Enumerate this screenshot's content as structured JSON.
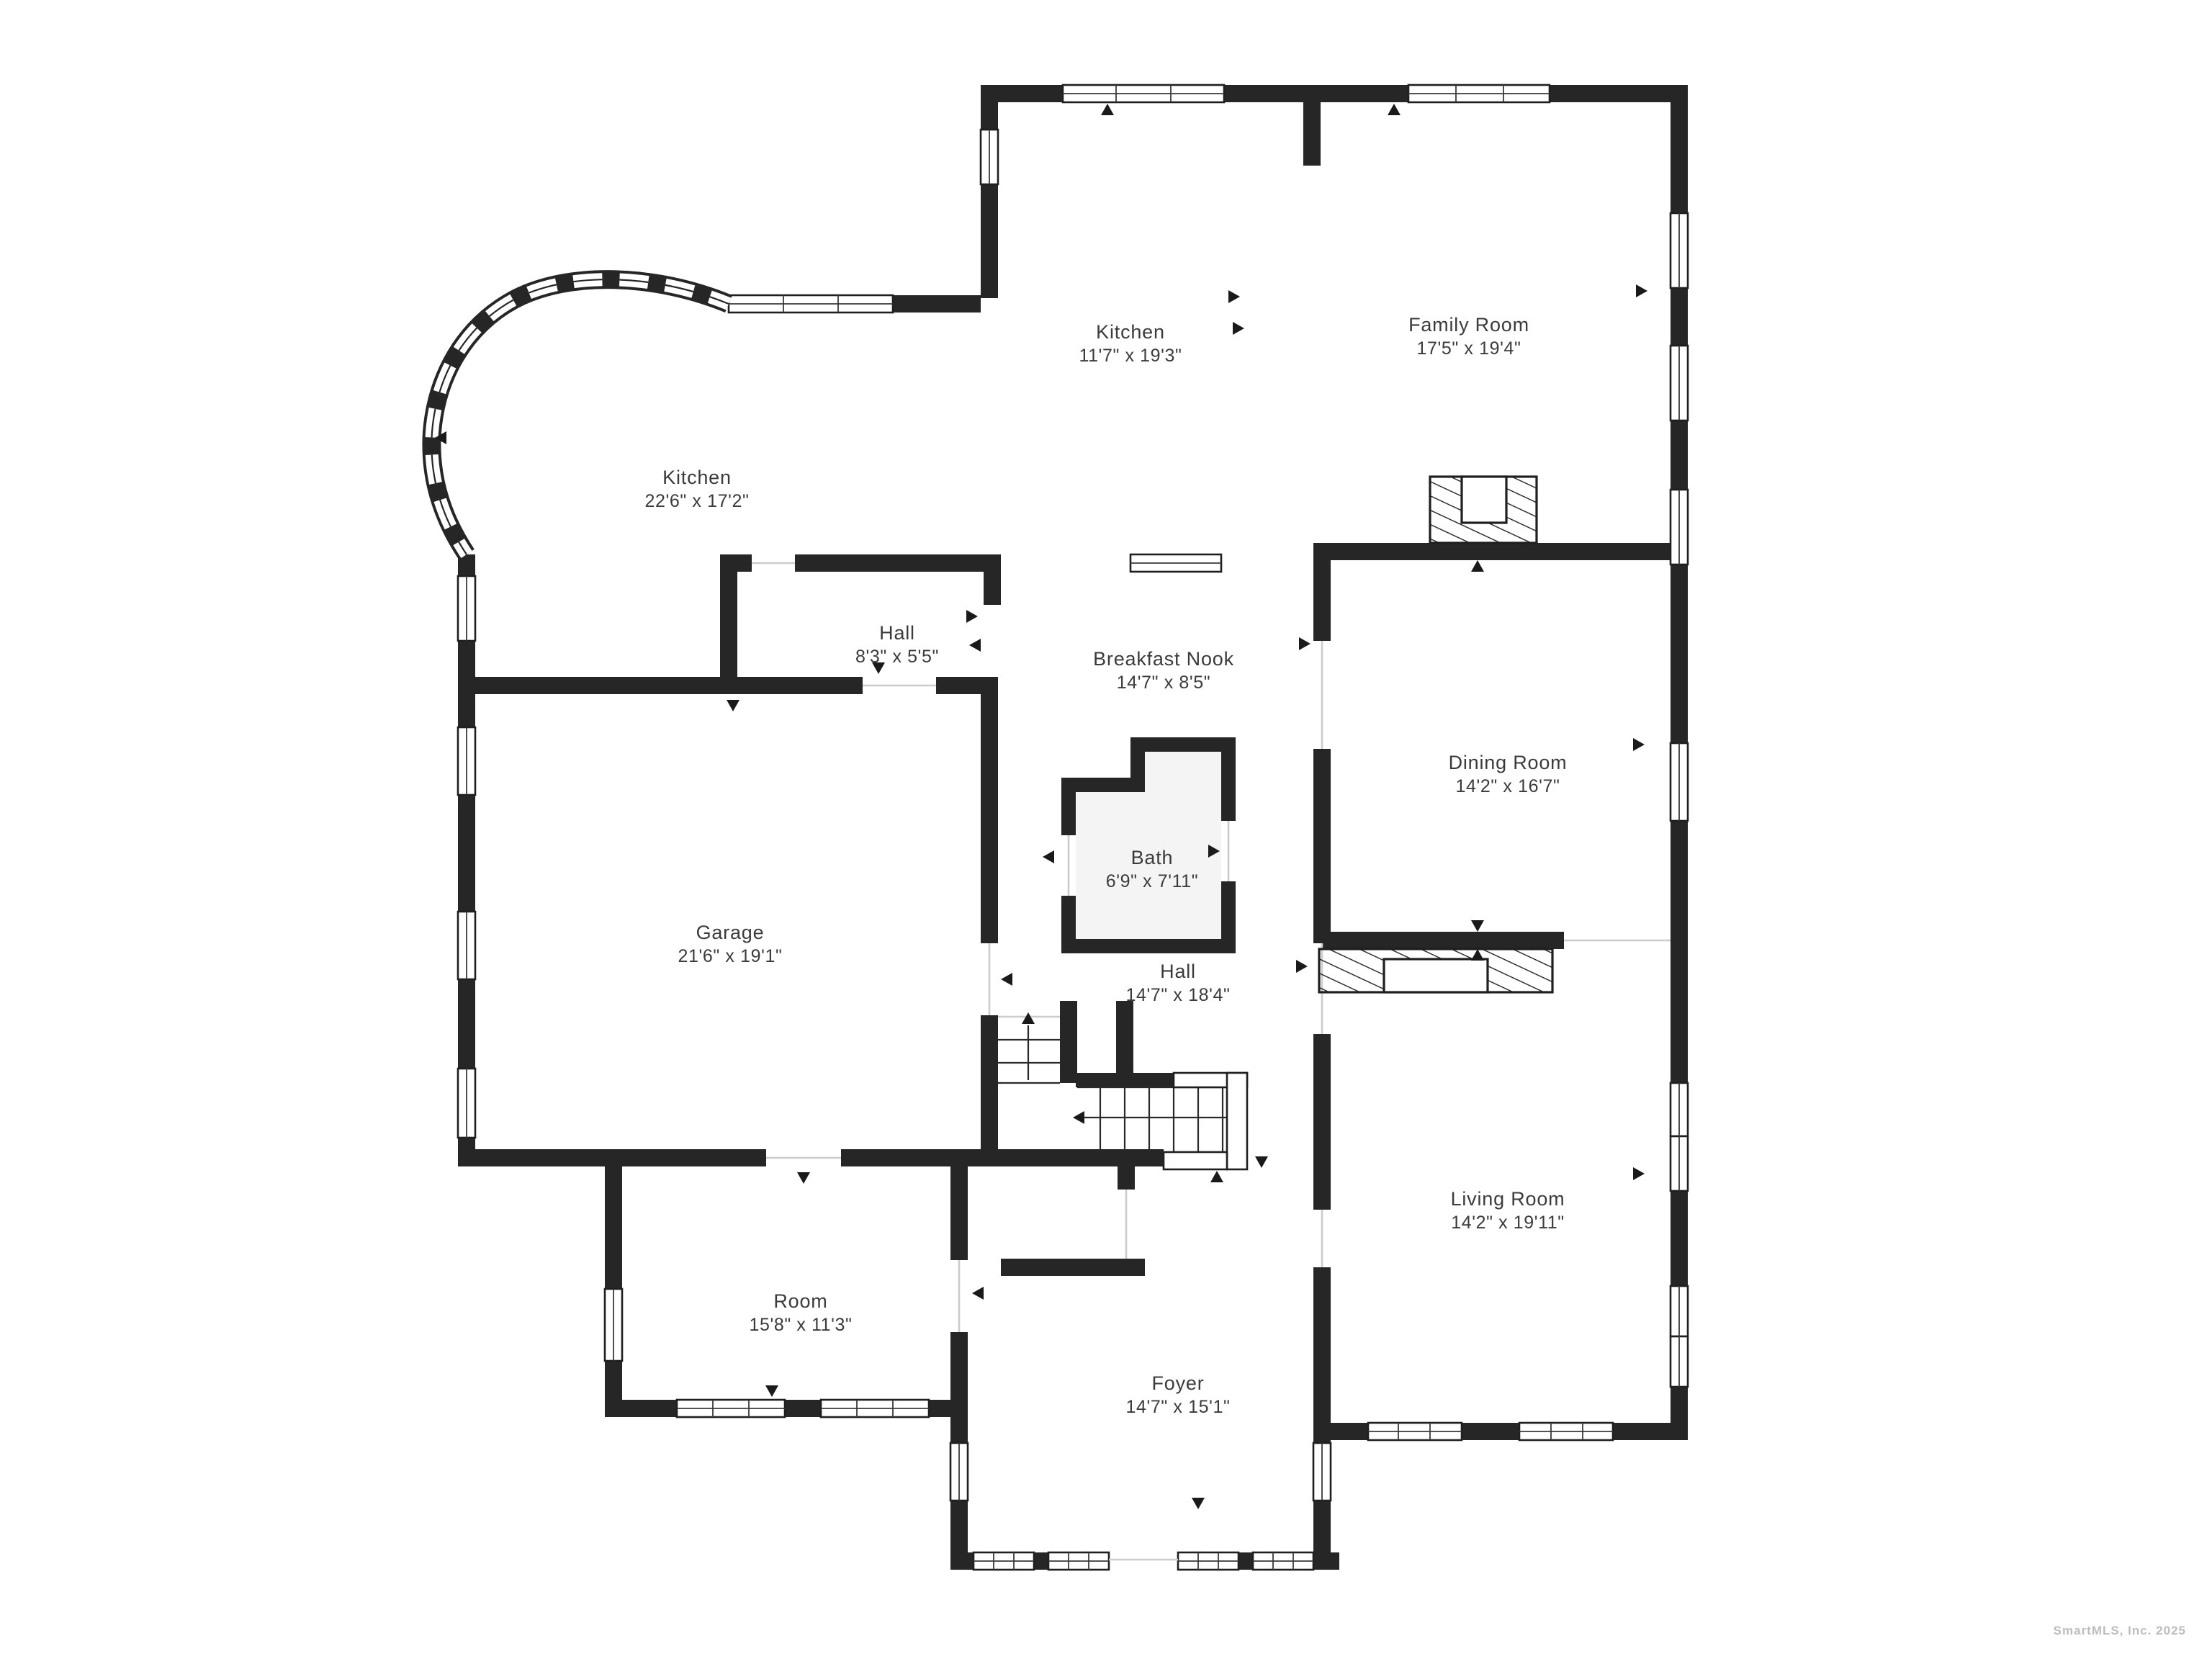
{
  "plan": {
    "rooms": [
      {
        "name": "Kitchen",
        "dims": "11'7\" x 19'3\""
      },
      {
        "name": "Family Room",
        "dims": "17'5\" x 19'4\""
      },
      {
        "name": "Kitchen",
        "dims": "22'6\" x 17'2\""
      },
      {
        "name": "Hall",
        "dims": "8'3\" x 5'5\""
      },
      {
        "name": "Breakfast Nook",
        "dims": "14'7\" x 8'5\""
      },
      {
        "name": "Dining Room",
        "dims": "14'2\" x 16'7\""
      },
      {
        "name": "Bath",
        "dims": "6'9\" x 7'11\""
      },
      {
        "name": "Garage",
        "dims": "21'6\" x 19'1\""
      },
      {
        "name": "Hall",
        "dims": "14'7\" x 18'4\""
      },
      {
        "name": "Living Room",
        "dims": "14'2\" x 19'11\""
      },
      {
        "name": "Room",
        "dims": "15'8\" x 11'3\""
      },
      {
        "name": "Foyer",
        "dims": "14'7\" x 15'1\""
      }
    ],
    "watermark": "SmartMLS, Inc.  2025",
    "colors": {
      "wall": "#262626",
      "label": "#3b3b3b",
      "watermark": "#bdbdbd",
      "bath_fill": "#f4f4f4",
      "opening_line": "#cccccc"
    }
  }
}
